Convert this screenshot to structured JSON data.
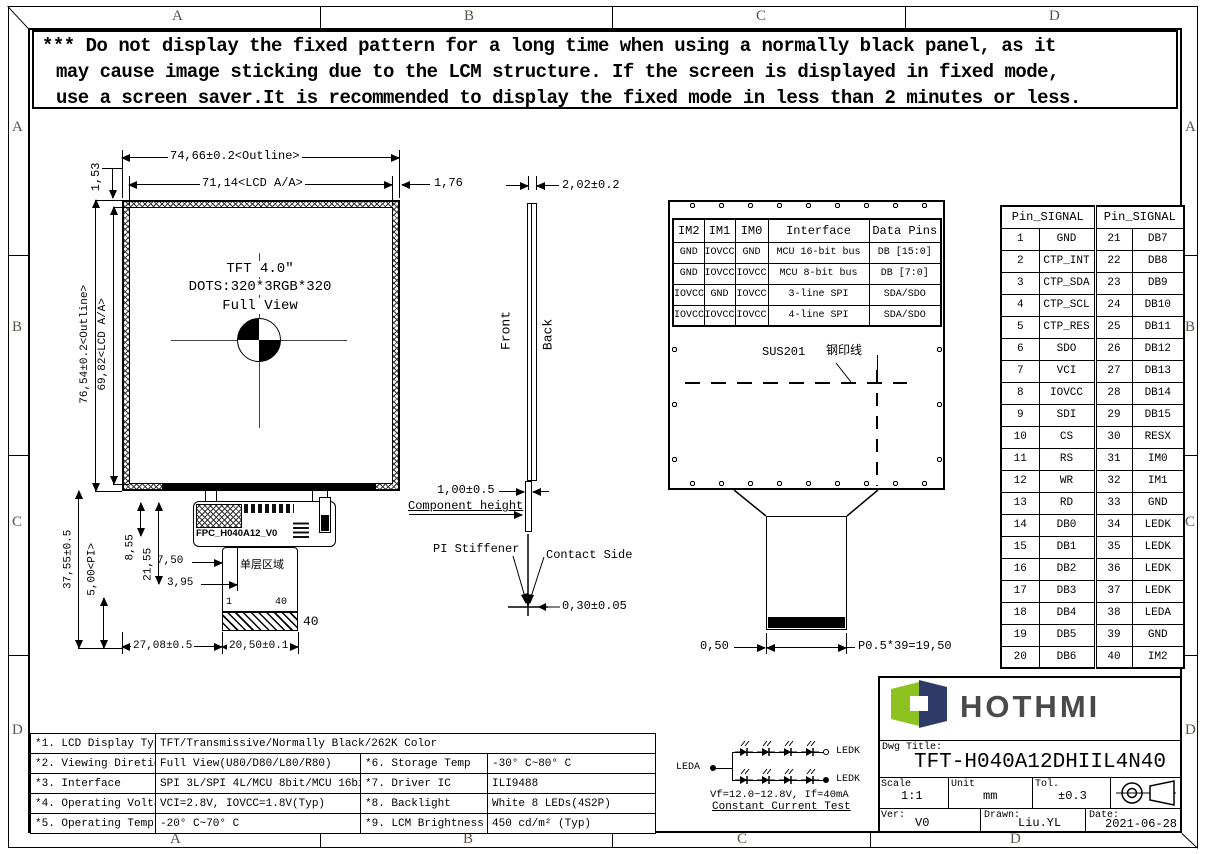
{
  "frame": {
    "top": [
      "A",
      "B",
      "C",
      "D"
    ],
    "bottom": [
      "A",
      "B",
      "C",
      "D"
    ],
    "left": [
      "A",
      "B",
      "C",
      "D"
    ],
    "right": [
      "A",
      "B",
      "C",
      "D"
    ]
  },
  "warning": {
    "lines": [
      "*** Do not display the fixed pattern for a long time when using a normally black panel, as it",
      "may cause image sticking due to the LCM structure. If the screen is displayed in fixed mode,",
      "use a screen saver.It is recommended to display the fixed mode in less than 2 minutes or less."
    ]
  },
  "front_view": {
    "dim_outline_w": "74,66±0.2<Outline>",
    "dim_aa_w": "71,14<LCD A/A>",
    "dim_right": "1,76",
    "dim_border_top": "1,53",
    "dim_outline_h": "76,54±0.2<Outline>",
    "dim_aa_h": "69,82<LCD A/A>",
    "center_line1": "TFT 4.0″",
    "center_line2": "DOTS:320*3RGB*320",
    "center_line3": "Full View"
  },
  "fpc": {
    "label": "FPC_H040A12_V0",
    "ak_label": "AK",
    "area_label": "单层区域",
    "pin_first": "1",
    "pin_last": "40",
    "pin_count": "40",
    "dim_total_h": "37,55±0.5",
    "dim_pi": "5,00<PI>",
    "dim_855": "8,55",
    "dim_2155": "21,55",
    "dim_750": "7,50",
    "dim_395": "3,95",
    "dim_2708": "27,08±0.5",
    "dim_2050": "20,50±0.1"
  },
  "side_view": {
    "front_label": "Front",
    "back_label": "Back",
    "dim_thickness": "2,02±0.2",
    "dim_component": "1,00±0.5",
    "component_label": "Component height",
    "stiffener_label": "PI Stiffener",
    "contact_label": "Contact Side",
    "dim_fpc_t": "0,30±0.05"
  },
  "back_view": {
    "sus_label": "SUS201",
    "steel_label": "钢印线",
    "dim_margin": "0,50",
    "dim_pitch": "P0.5*39=19,50"
  },
  "im_table": {
    "headers": [
      "IM2",
      "IM1",
      "IM0",
      "Interface",
      "Data Pins"
    ],
    "rows": [
      [
        "GND",
        "IOVCC",
        "GND",
        "MCU 16-bit bus",
        "DB [15:0]"
      ],
      [
        "GND",
        "IOVCC",
        "IOVCC",
        "MCU 8-bit bus",
        "DB [7:0]"
      ],
      [
        "IOVCC",
        "GND",
        "IOVCC",
        "3-line SPI",
        "SDA/SDO"
      ],
      [
        "IOVCC",
        "IOVCC",
        "IOVCC",
        "4-line SPI",
        "SDA/SDO"
      ]
    ]
  },
  "pin_table": {
    "header_left": "Pin_SIGNAL",
    "header_right": "Pin_SIGNAL",
    "rows": [
      [
        "1",
        "GND",
        "21",
        "DB7"
      ],
      [
        "2",
        "CTP_INT",
        "22",
        "DB8"
      ],
      [
        "3",
        "CTP_SDA",
        "23",
        "DB9"
      ],
      [
        "4",
        "CTP_SCL",
        "24",
        "DB10"
      ],
      [
        "5",
        "CTP_RES",
        "25",
        "DB11"
      ],
      [
        "6",
        "SDO",
        "26",
        "DB12"
      ],
      [
        "7",
        "VCI",
        "27",
        "DB13"
      ],
      [
        "8",
        "IOVCC",
        "28",
        "DB14"
      ],
      [
        "9",
        "SDI",
        "29",
        "DB15"
      ],
      [
        "10",
        "CS",
        "30",
        "RESX"
      ],
      [
        "11",
        "RS",
        "31",
        "IM0"
      ],
      [
        "12",
        "WR",
        "32",
        "IM1"
      ],
      [
        "13",
        "RD",
        "33",
        "GND"
      ],
      [
        "14",
        "DB0",
        "34",
        "LEDK"
      ],
      [
        "15",
        "DB1",
        "35",
        "LEDK"
      ],
      [
        "16",
        "DB2",
        "36",
        "LEDK"
      ],
      [
        "17",
        "DB3",
        "37",
        "LEDK"
      ],
      [
        "18",
        "DB4",
        "38",
        "LEDA"
      ],
      [
        "19",
        "DB5",
        "39",
        "GND"
      ],
      [
        "20",
        "DB6",
        "40",
        "IM2"
      ]
    ]
  },
  "spec_table": {
    "row1_label": "*1. LCD Display Type",
    "row1_value": "TFT/Transmissive/Normally Black/262K Color",
    "rows": [
      [
        "*2. Viewing Diretion",
        "Full View(U80/D80/L80/R80)",
        "*6. Storage Temp",
        "-30° C~80° C"
      ],
      [
        "*3. Interface",
        "SPI 3L/SPI 4L/MCU 8bit/MCU 16bit",
        "*7. Driver IC",
        "ILI9488"
      ],
      [
        "*4. Operating Voltage",
        "VCI=2.8V, IOVCC=1.8V(Typ)",
        "*8. Backlight",
        "White 8 LEDs(4S2P)"
      ],
      [
        "*5. Operating Temp",
        "-20° C~70° C",
        "*9. LCM Brightness",
        "450 cd/m²  (Typ)"
      ]
    ]
  },
  "led_circuit": {
    "leda_label": "LEDA",
    "ledk_top_label": "LEDK",
    "ledk_bottom_label": "LEDK",
    "vf_text": "Vf=12.0~12.8V, If=40mA",
    "test_text": "Constant Current Test"
  },
  "title_block": {
    "logo_text": "HOTHMI",
    "dwg_title_label": "Dwg Title:",
    "dwg_title": "TFT-H040A12DHIIL4N40",
    "scale_label": "Scale",
    "scale_value": "1:1",
    "unit_label": "Unit",
    "unit_value": "mm",
    "tol_label": "Tol.",
    "tol_value": "±0.3",
    "ver_label": "Ver:",
    "ver_value": "V0",
    "drawn_label": "Drawn:",
    "drawn_value": "Liu.YL",
    "date_label": "Date:",
    "date_value": "2021-06-28"
  },
  "colors": {
    "logo_green": "#8dc21f",
    "logo_navy": "#2e3a68",
    "logo_text": "#4a4a4a",
    "line_color": "#000000"
  }
}
